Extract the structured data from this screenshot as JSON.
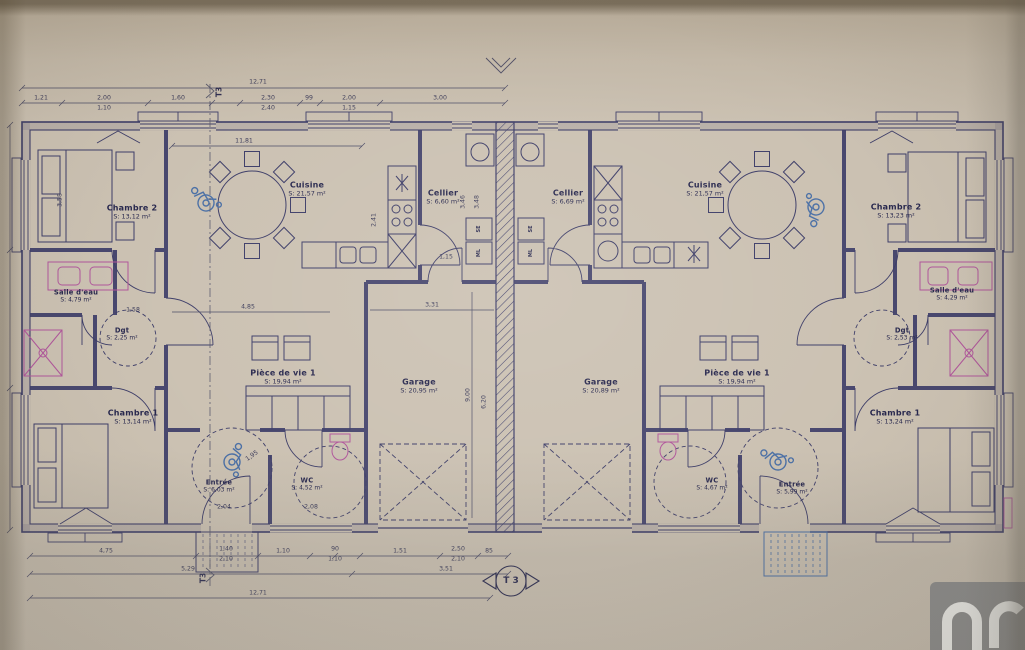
{
  "document": {
    "plan_type": "T 3",
    "section_marker": "T3",
    "watermark": "im"
  },
  "rooms": {
    "left": {
      "chambre2": {
        "name": "Chambre 2",
        "area": "S: 13,12 m²"
      },
      "cuisine": {
        "name": "Cuisine",
        "area": "S: 21,57 m²"
      },
      "cellier": {
        "name": "Cellier",
        "area": "S: 6,60 m²"
      },
      "salle_eau": {
        "name": "Salle d'eau",
        "area": "S: 4,79 m²"
      },
      "dgt": {
        "name": "Dgt",
        "area": "S: 2,25 m²"
      },
      "piece_vie": {
        "name": "Pièce de vie 1",
        "area": "S: 19,94 m²"
      },
      "chambre1": {
        "name": "Chambre 1",
        "area": "S: 13,14 m²"
      },
      "entree": {
        "name": "Entrée",
        "area": "S: 6,03 m²"
      },
      "wc": {
        "name": "WC",
        "area": "S: 4,52 m²"
      },
      "garage": {
        "name": "Garage",
        "area": "S: 20,95 m²"
      }
    },
    "right": {
      "cellier": {
        "name": "Cellier",
        "area": "S: 6,69 m²"
      },
      "cuisine": {
        "name": "Cuisine",
        "area": "S: 21,57 m²"
      },
      "chambre2": {
        "name": "Chambre 2",
        "area": "S: 13,23 m²"
      },
      "salle_eau": {
        "name": "Salle d'eau",
        "area": "S: 4,29 m²"
      },
      "dgt": {
        "name": "Dgt",
        "area": "S: 2,53 m²"
      },
      "garage": {
        "name": "Garage",
        "area": "S: 20,89 m²"
      },
      "piece_vie": {
        "name": "Pièce de vie 1",
        "area": "S: 19,94 m²"
      },
      "wc": {
        "name": "WC",
        "area": "S: 4,67 m²"
      },
      "entree": {
        "name": "Entrée",
        "area": "S: 5,99 m²"
      },
      "chambre1": {
        "name": "Chambre 1",
        "area": "S: 13,24 m²"
      }
    }
  },
  "appliances": {
    "se": "SE",
    "ml": "ML"
  },
  "dimensions": {
    "overall": "12,71",
    "top_segments": [
      "1,21",
      "2,00",
      "1,10",
      "1,60",
      "2,30",
      "2,40",
      "99",
      "2,00",
      "1,15",
      "3,00"
    ],
    "bottom_row1": [
      "4,75",
      "1,40",
      "2,10",
      "1,10",
      "90",
      "1,10",
      "1,51",
      "2,50",
      "2,10",
      "85"
    ],
    "bottom_row2": [
      "5,29",
      "3,51"
    ],
    "interior": [
      "11,81",
      "2,41",
      "3,46",
      "3,48",
      "3,31",
      "4,85",
      "9,00",
      "6,20",
      "1,95",
      "2,04",
      "2,08",
      "1,15",
      "3,58",
      "1,58"
    ]
  }
}
